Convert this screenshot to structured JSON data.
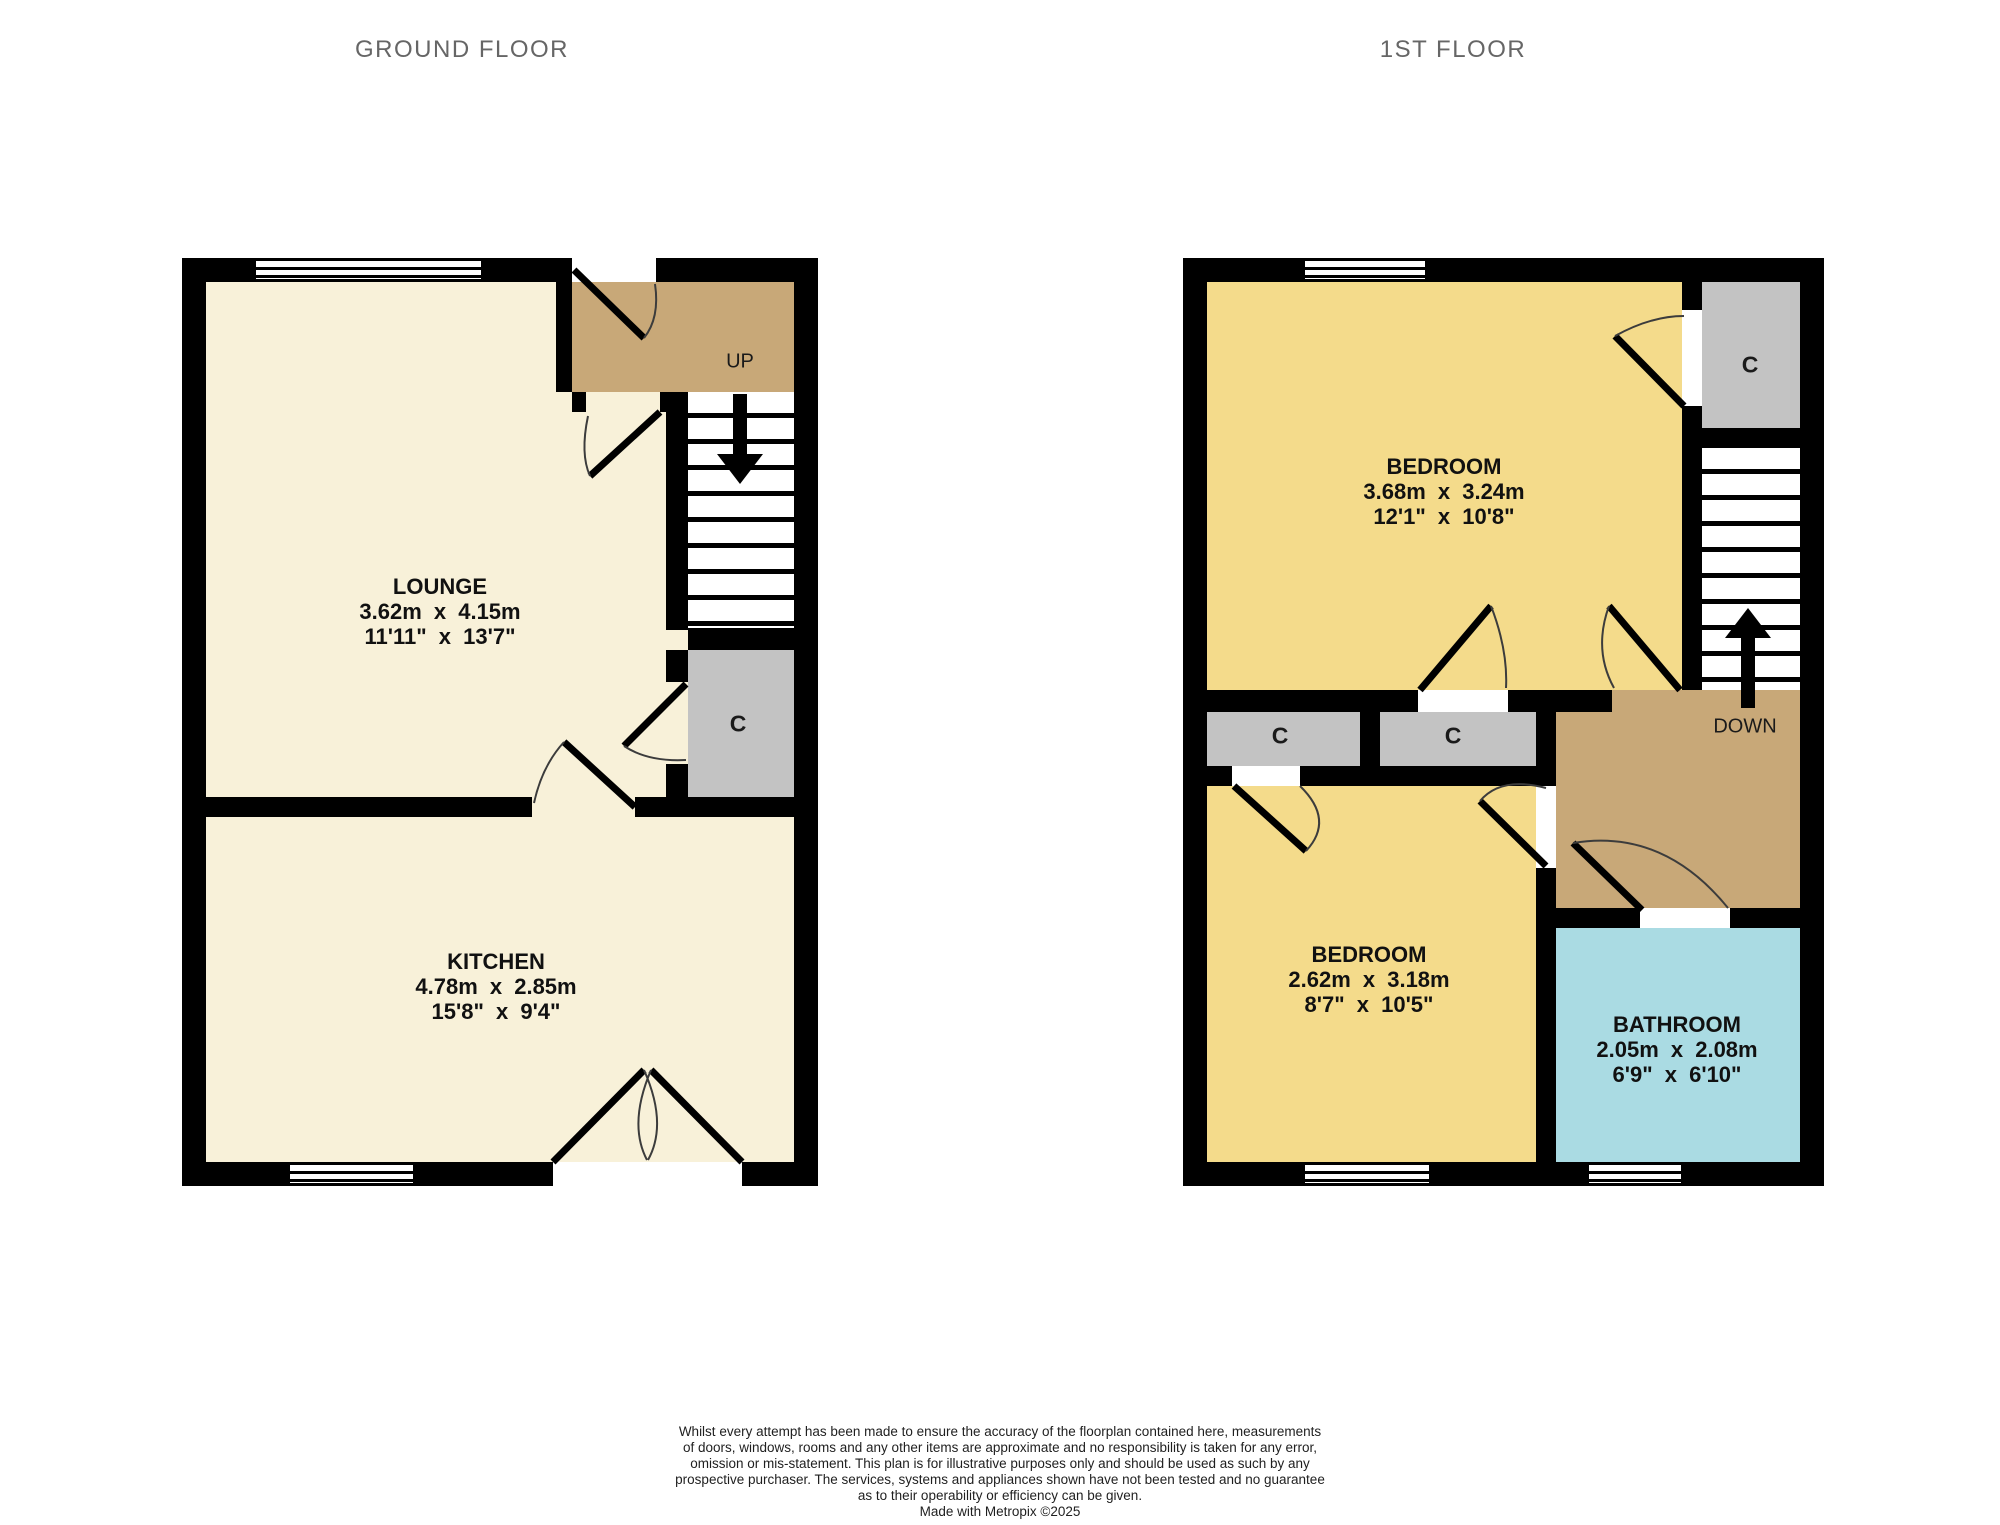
{
  "titles": {
    "ground_floor": "GROUND FLOOR",
    "first_floor": "1ST FLOOR"
  },
  "ground_floor": {
    "lounge": {
      "name": "LOUNGE",
      "metric": "3.62m x 4.15m",
      "imperial": "11'11\" x 13'7\""
    },
    "kitchen": {
      "name": "KITCHEN",
      "metric": "4.78m x 2.85m",
      "imperial": "15'8\" x 9'4\""
    },
    "stairs_label": "UP",
    "cupboard_label": "C"
  },
  "first_floor": {
    "bedroom1": {
      "name": "BEDROOM",
      "metric": "3.68m x 3.24m",
      "imperial": "12'1\" x 10'8\""
    },
    "bedroom2": {
      "name": "BEDROOM",
      "metric": "2.62m x 3.18m",
      "imperial": "8'7\" x 10'5\""
    },
    "bathroom": {
      "name": "BATHROOM",
      "metric": "2.05m x 2.08m",
      "imperial": "6'9\" x 6'10\""
    },
    "stairs_label": "DOWN",
    "cupboard_top_label": "C",
    "cupboard_left_label": "C",
    "cupboard_mid_label": "C"
  },
  "footer": {
    "lines": [
      "Whilst every attempt has been made to ensure the accuracy of the floorplan contained here, measurements",
      "of doors, windows, rooms and any other items are approximate and no responsibility is taken for any error,",
      "omission or mis-statement. This plan is for illustrative purposes only and should be used as such by any",
      "prospective purchaser. The services, systems and appliances shown have not been tested and no guarantee",
      "as to their operability or efficiency can be given.",
      "Made with Metropix ©2025"
    ]
  },
  "colors": {
    "wall": "#000000",
    "room_cream": "#f8f1d9",
    "hall_tan": "#c8a878",
    "bedroom_yellow": "#f4db8b",
    "bathroom_blue": "#aadbe3",
    "cupboard_grey": "#c3c3c3",
    "title_grey": "#666666"
  }
}
